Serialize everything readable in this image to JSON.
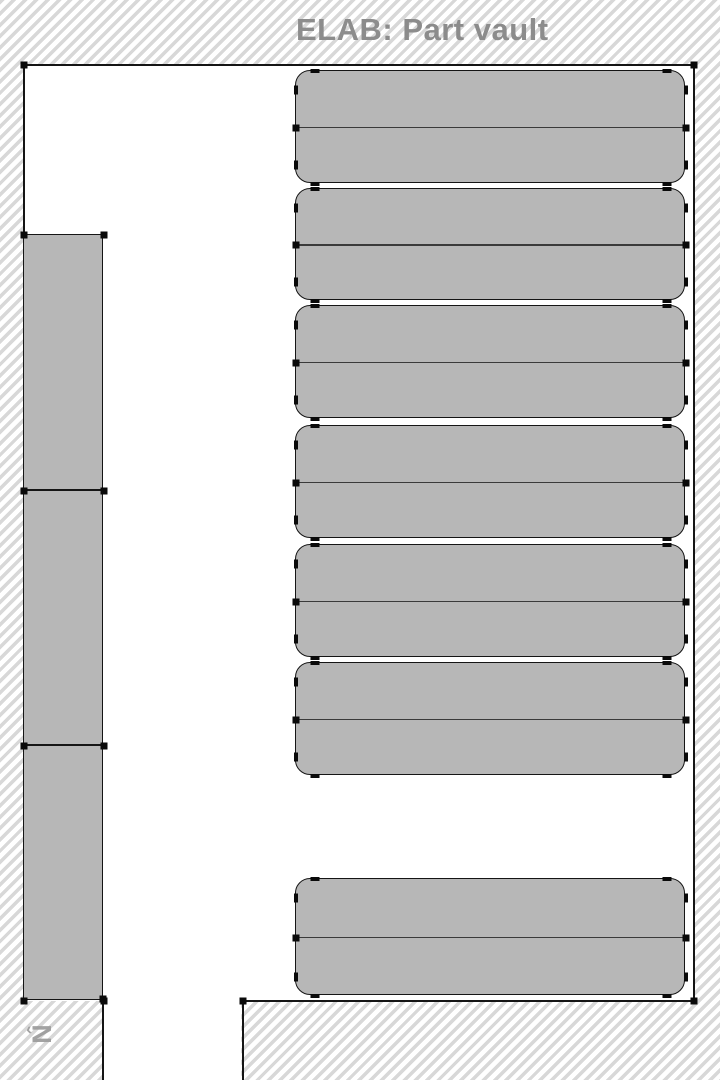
{
  "title": "ELAB: Part vault",
  "compass": {
    "arrow": "‹",
    "letter": "N"
  },
  "colors": {
    "shelf_fill": "#b7b7b7",
    "line": "#151515",
    "hatch_stripe": "#d8d8d8",
    "title_text": "#8c8c8c",
    "compass_text": "#9a9a9a",
    "floor": "#ffffff"
  },
  "floorplan": {
    "canvas": {
      "width": 720,
      "height": 1080
    },
    "floor_areas": [
      {
        "x": 24,
        "y": 65,
        "w": 669,
        "h": 936
      },
      {
        "x": 104,
        "y": 999,
        "w": 137,
        "h": 81
      }
    ],
    "walls": [
      {
        "x": 23,
        "y": 64,
        "w": 672,
        "h": 2
      },
      {
        "x": 23,
        "y": 64,
        "w": 2,
        "h": 937
      },
      {
        "x": 693,
        "y": 64,
        "w": 2,
        "h": 938
      },
      {
        "x": 242,
        "y": 1000,
        "w": 453,
        "h": 2
      },
      {
        "x": 242,
        "y": 1000,
        "w": 2,
        "h": 80
      },
      {
        "x": 102,
        "y": 998,
        "w": 2,
        "h": 82
      }
    ],
    "corner_markers": [
      {
        "x": 24,
        "y": 65
      },
      {
        "x": 694,
        "y": 65
      },
      {
        "x": 694,
        "y": 1001
      },
      {
        "x": 243,
        "y": 1001
      },
      {
        "x": 103,
        "y": 999
      }
    ],
    "shelf_groups": [
      {
        "x": 295,
        "y": 70,
        "w": 390,
        "h": 113,
        "radius": 15
      },
      {
        "x": 295,
        "y": 188,
        "w": 390,
        "h": 112,
        "radius": 15
      },
      {
        "x": 295,
        "y": 305,
        "w": 390,
        "h": 113,
        "radius": 15
      },
      {
        "x": 295,
        "y": 425,
        "w": 390,
        "h": 113,
        "radius": 15
      },
      {
        "x": 295,
        "y": 544,
        "w": 390,
        "h": 113,
        "radius": 15
      },
      {
        "x": 295,
        "y": 662,
        "w": 390,
        "h": 113,
        "radius": 15
      },
      {
        "x": 295,
        "y": 878,
        "w": 390,
        "h": 117,
        "radius": 15
      }
    ],
    "wall_racks": [
      {
        "x": 23,
        "y": 234,
        "w": 80,
        "h": 256
      },
      {
        "x": 23,
        "y": 490,
        "w": 80,
        "h": 255
      },
      {
        "x": 23,
        "y": 745,
        "w": 80,
        "h": 255
      }
    ]
  }
}
